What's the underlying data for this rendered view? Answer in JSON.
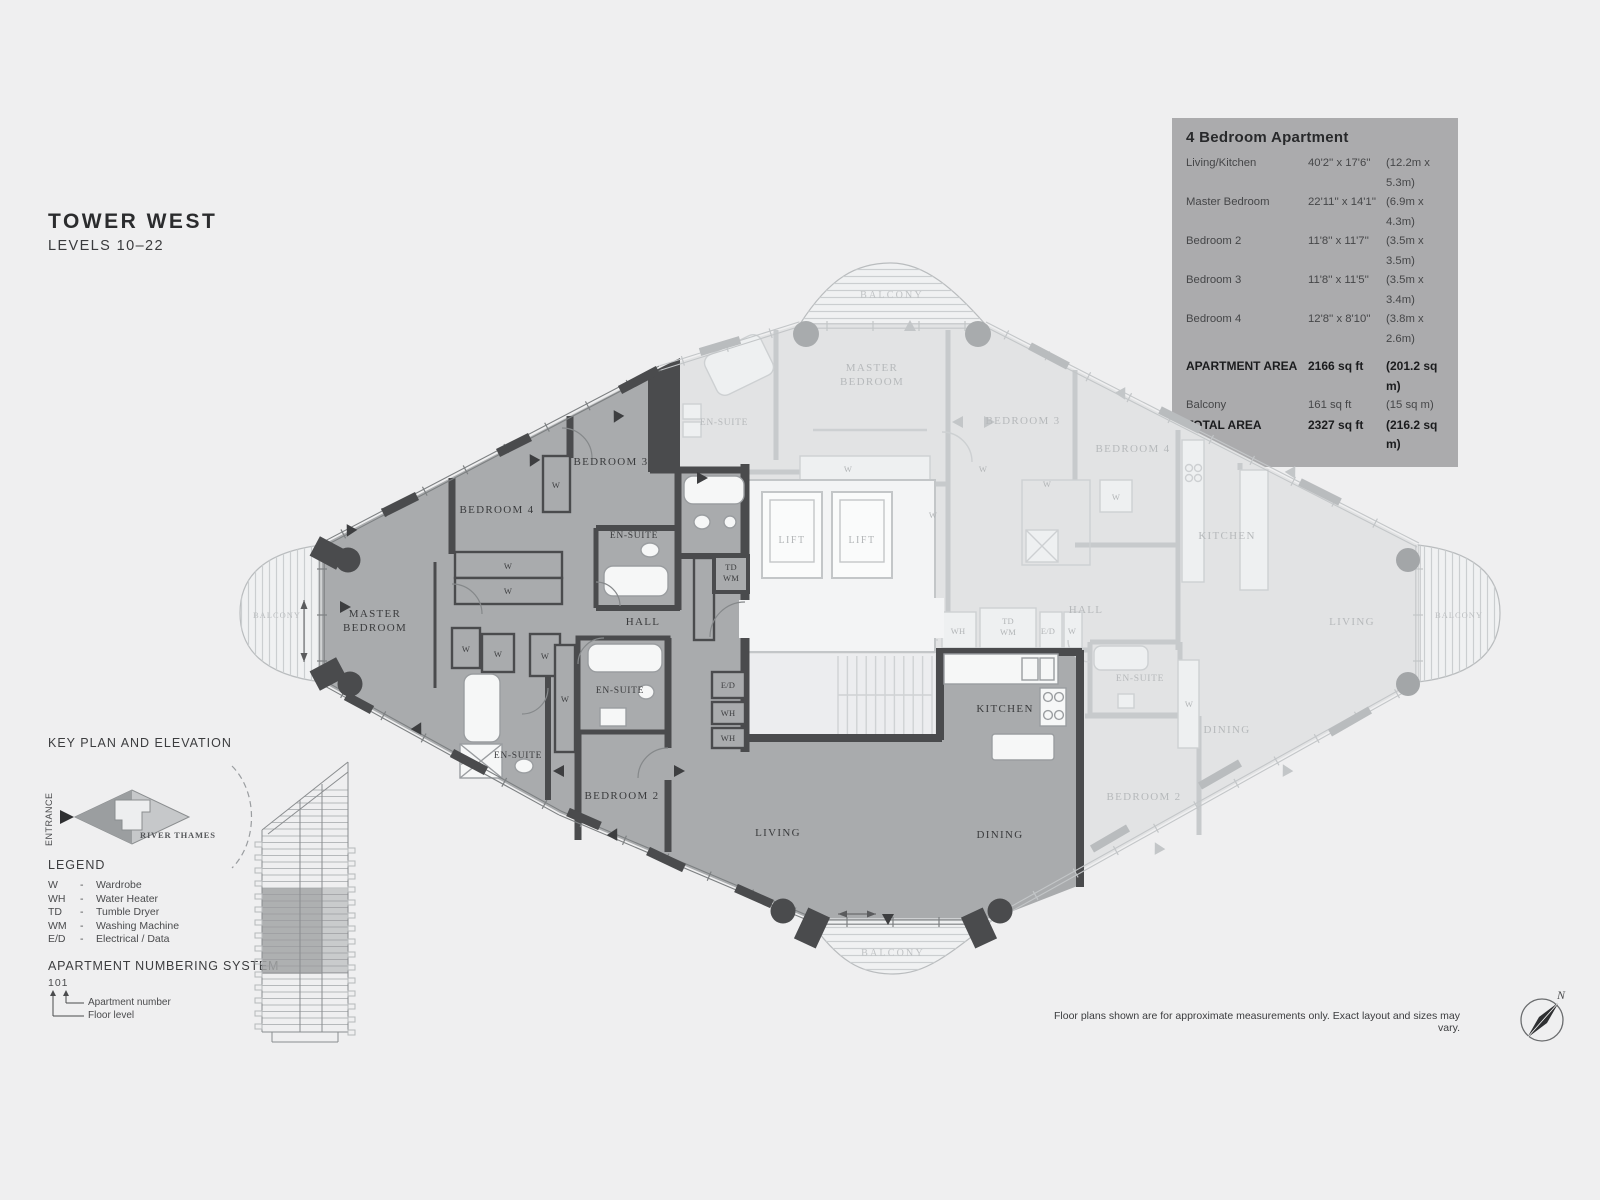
{
  "header": {
    "title": "TOWER WEST",
    "subtitle": "LEVELS 10–22"
  },
  "info_panel": {
    "heading": "4 Bedroom Apartment",
    "rows": [
      {
        "label": "Living/Kitchen",
        "imperial": "40'2'' x 17'6''",
        "metric": "(12.2m x 5.3m)",
        "bold": false,
        "gap": false
      },
      {
        "label": "Master Bedroom",
        "imperial": "22'11'' x 14'1''",
        "metric": "(6.9m x 4.3m)",
        "bold": false,
        "gap": false
      },
      {
        "label": "Bedroom 2",
        "imperial": "11'8'' x 11'7''",
        "metric": "(3.5m x 3.5m)",
        "bold": false,
        "gap": false
      },
      {
        "label": "Bedroom 3",
        "imperial": "11'8'' x 11'5''",
        "metric": "(3.5m x 3.4m)",
        "bold": false,
        "gap": false
      },
      {
        "label": "Bedroom 4",
        "imperial": "12'8'' x 8'10''",
        "metric": "(3.8m x 2.6m)",
        "bold": false,
        "gap": false
      },
      {
        "label": "APARTMENT AREA",
        "imperial": "2166 sq ft",
        "metric": "(201.2 sq m)",
        "bold": true,
        "gap": true
      },
      {
        "label": "Balcony",
        "imperial": "161 sq ft",
        "metric": "(15 sq m)",
        "bold": false,
        "gap": false
      },
      {
        "label": "TOTAL AREA",
        "imperial": "2327 sq ft",
        "metric": "(216.2 sq m)",
        "bold": true,
        "gap": false
      }
    ]
  },
  "key_plan": {
    "heading": "KEY PLAN AND ELEVATION",
    "entrance_label": "ENTRANCE",
    "river_label": "RIVER THAMES"
  },
  "legend": {
    "heading": "LEGEND",
    "dash": "-",
    "items": [
      {
        "abbr": "W",
        "desc": "Wardrobe"
      },
      {
        "abbr": "WH",
        "desc": "Water Heater"
      },
      {
        "abbr": "TD",
        "desc": "Tumble Dryer"
      },
      {
        "abbr": "WM",
        "desc": "Washing Machine"
      },
      {
        "abbr": "E/D",
        "desc": "Electrical / Data"
      }
    ]
  },
  "numbering": {
    "heading": "APARTMENT NUMBERING SYSTEM",
    "example": "101",
    "apartment_label": "Apartment number",
    "floor_label": "Floor level"
  },
  "disclaimer": "Floor plans shown are for approximate measurements only. Exact layout and sizes may vary.",
  "compass": {
    "north_label": "N"
  },
  "floor_plan": {
    "labels": [
      {
        "t": "MASTER\nBEDROOM",
        "x": 375,
        "y": 617,
        "c": "hl",
        "lh": 14
      },
      {
        "t": "BEDROOM 4",
        "x": 497,
        "y": 513,
        "c": "hl"
      },
      {
        "t": "BEDROOM 3",
        "x": 611,
        "y": 465,
        "c": "hl"
      },
      {
        "t": "EN-SUITE",
        "x": 634,
        "y": 538,
        "c": "hl-sm"
      },
      {
        "t": "HALL",
        "x": 643,
        "y": 625,
        "c": "hl"
      },
      {
        "t": "EN-SUITE",
        "x": 620,
        "y": 693,
        "c": "hl-sm"
      },
      {
        "t": "EN-SUITE",
        "x": 518,
        "y": 758,
        "c": "hl-sm"
      },
      {
        "t": "BEDROOM 2",
        "x": 622,
        "y": 799,
        "c": "hl"
      },
      {
        "t": "LIVING",
        "x": 778,
        "y": 836,
        "c": "hl"
      },
      {
        "t": "DINING",
        "x": 1000,
        "y": 838,
        "c": "hl"
      },
      {
        "t": "KITCHEN",
        "x": 1005,
        "y": 712,
        "c": "hl"
      },
      {
        "t": "TD\nWM",
        "x": 731,
        "y": 570,
        "c": "hl-xs",
        "lh": 11
      },
      {
        "t": "E/D",
        "x": 728,
        "y": 688,
        "c": "hl-xs"
      },
      {
        "t": "WH",
        "x": 728,
        "y": 716,
        "c": "hl-xs"
      },
      {
        "t": "WH",
        "x": 728,
        "y": 741,
        "c": "hl-xs"
      },
      {
        "t": "W",
        "x": 508,
        "y": 569,
        "c": "hl-xs"
      },
      {
        "t": "W",
        "x": 508,
        "y": 594,
        "c": "hl-xs"
      },
      {
        "t": "W",
        "x": 556,
        "y": 488,
        "c": "hl-xs"
      },
      {
        "t": "W",
        "x": 466,
        "y": 652,
        "c": "hl-xs"
      },
      {
        "t": "W",
        "x": 498,
        "y": 657,
        "c": "hl-xs"
      },
      {
        "t": "W",
        "x": 545,
        "y": 659,
        "c": "hl-xs"
      },
      {
        "t": "W",
        "x": 565,
        "y": 702,
        "c": "hl-xs"
      },
      {
        "t": "BALCONY",
        "x": 892,
        "y": 298,
        "c": "bal"
      },
      {
        "t": "BALCONY",
        "x": 893,
        "y": 956,
        "c": "bal"
      },
      {
        "t": "BALCONY",
        "x": 277,
        "y": 618,
        "c": "bal-sm"
      },
      {
        "t": "BALCONY",
        "x": 1459,
        "y": 618,
        "c": "bal-sm"
      },
      {
        "t": "MASTER\nBEDROOM",
        "x": 872,
        "y": 371,
        "c": "fd",
        "lh": 14
      },
      {
        "t": "EN-SUITE",
        "x": 724,
        "y": 425,
        "c": "fd-sm"
      },
      {
        "t": "BEDROOM 3",
        "x": 1023,
        "y": 424,
        "c": "fd"
      },
      {
        "t": "BEDROOM 4",
        "x": 1133,
        "y": 452,
        "c": "fd"
      },
      {
        "t": "KITCHEN",
        "x": 1227,
        "y": 539,
        "c": "fd"
      },
      {
        "t": "HALL",
        "x": 1086,
        "y": 613,
        "c": "fd"
      },
      {
        "t": "EN-SUITE",
        "x": 1140,
        "y": 681,
        "c": "fd-sm"
      },
      {
        "t": "DINING",
        "x": 1227,
        "y": 733,
        "c": "fd"
      },
      {
        "t": "BEDROOM 2",
        "x": 1144,
        "y": 800,
        "c": "fd"
      },
      {
        "t": "LIVING",
        "x": 1352,
        "y": 625,
        "c": "fd"
      },
      {
        "t": "LIFT",
        "x": 792,
        "y": 543,
        "c": "lift"
      },
      {
        "t": "LIFT",
        "x": 862,
        "y": 543,
        "c": "lift"
      },
      {
        "t": "WH",
        "x": 958,
        "y": 634,
        "c": "fd-xs"
      },
      {
        "t": "TD\nWM",
        "x": 1008,
        "y": 624,
        "c": "fd-xs",
        "lh": 11
      },
      {
        "t": "E/D",
        "x": 1048,
        "y": 634,
        "c": "fd-xs"
      },
      {
        "t": "W",
        "x": 1072,
        "y": 634,
        "c": "fd-xs"
      },
      {
        "t": "W",
        "x": 848,
        "y": 472,
        "c": "fd-xs"
      },
      {
        "t": "W",
        "x": 933,
        "y": 518,
        "c": "fd-xs"
      },
      {
        "t": "W",
        "x": 983,
        "y": 472,
        "c": "fd-xs"
      },
      {
        "t": "W",
        "x": 1047,
        "y": 487,
        "c": "fd-xs"
      },
      {
        "t": "W",
        "x": 1116,
        "y": 500,
        "c": "fd-xs"
      },
      {
        "t": "W",
        "x": 1189,
        "y": 707,
        "c": "fd-xs"
      }
    ]
  },
  "colors": {
    "page_bg": "#efeff0",
    "highlight_floor": "#a9abad",
    "highlight_wall": "#4a4b4d",
    "faded_floor": "#e2e3e4",
    "faded_wall": "#c7cacc",
    "panel_bg": "#ababad",
    "fixture_white": "#f6f7f7"
  }
}
